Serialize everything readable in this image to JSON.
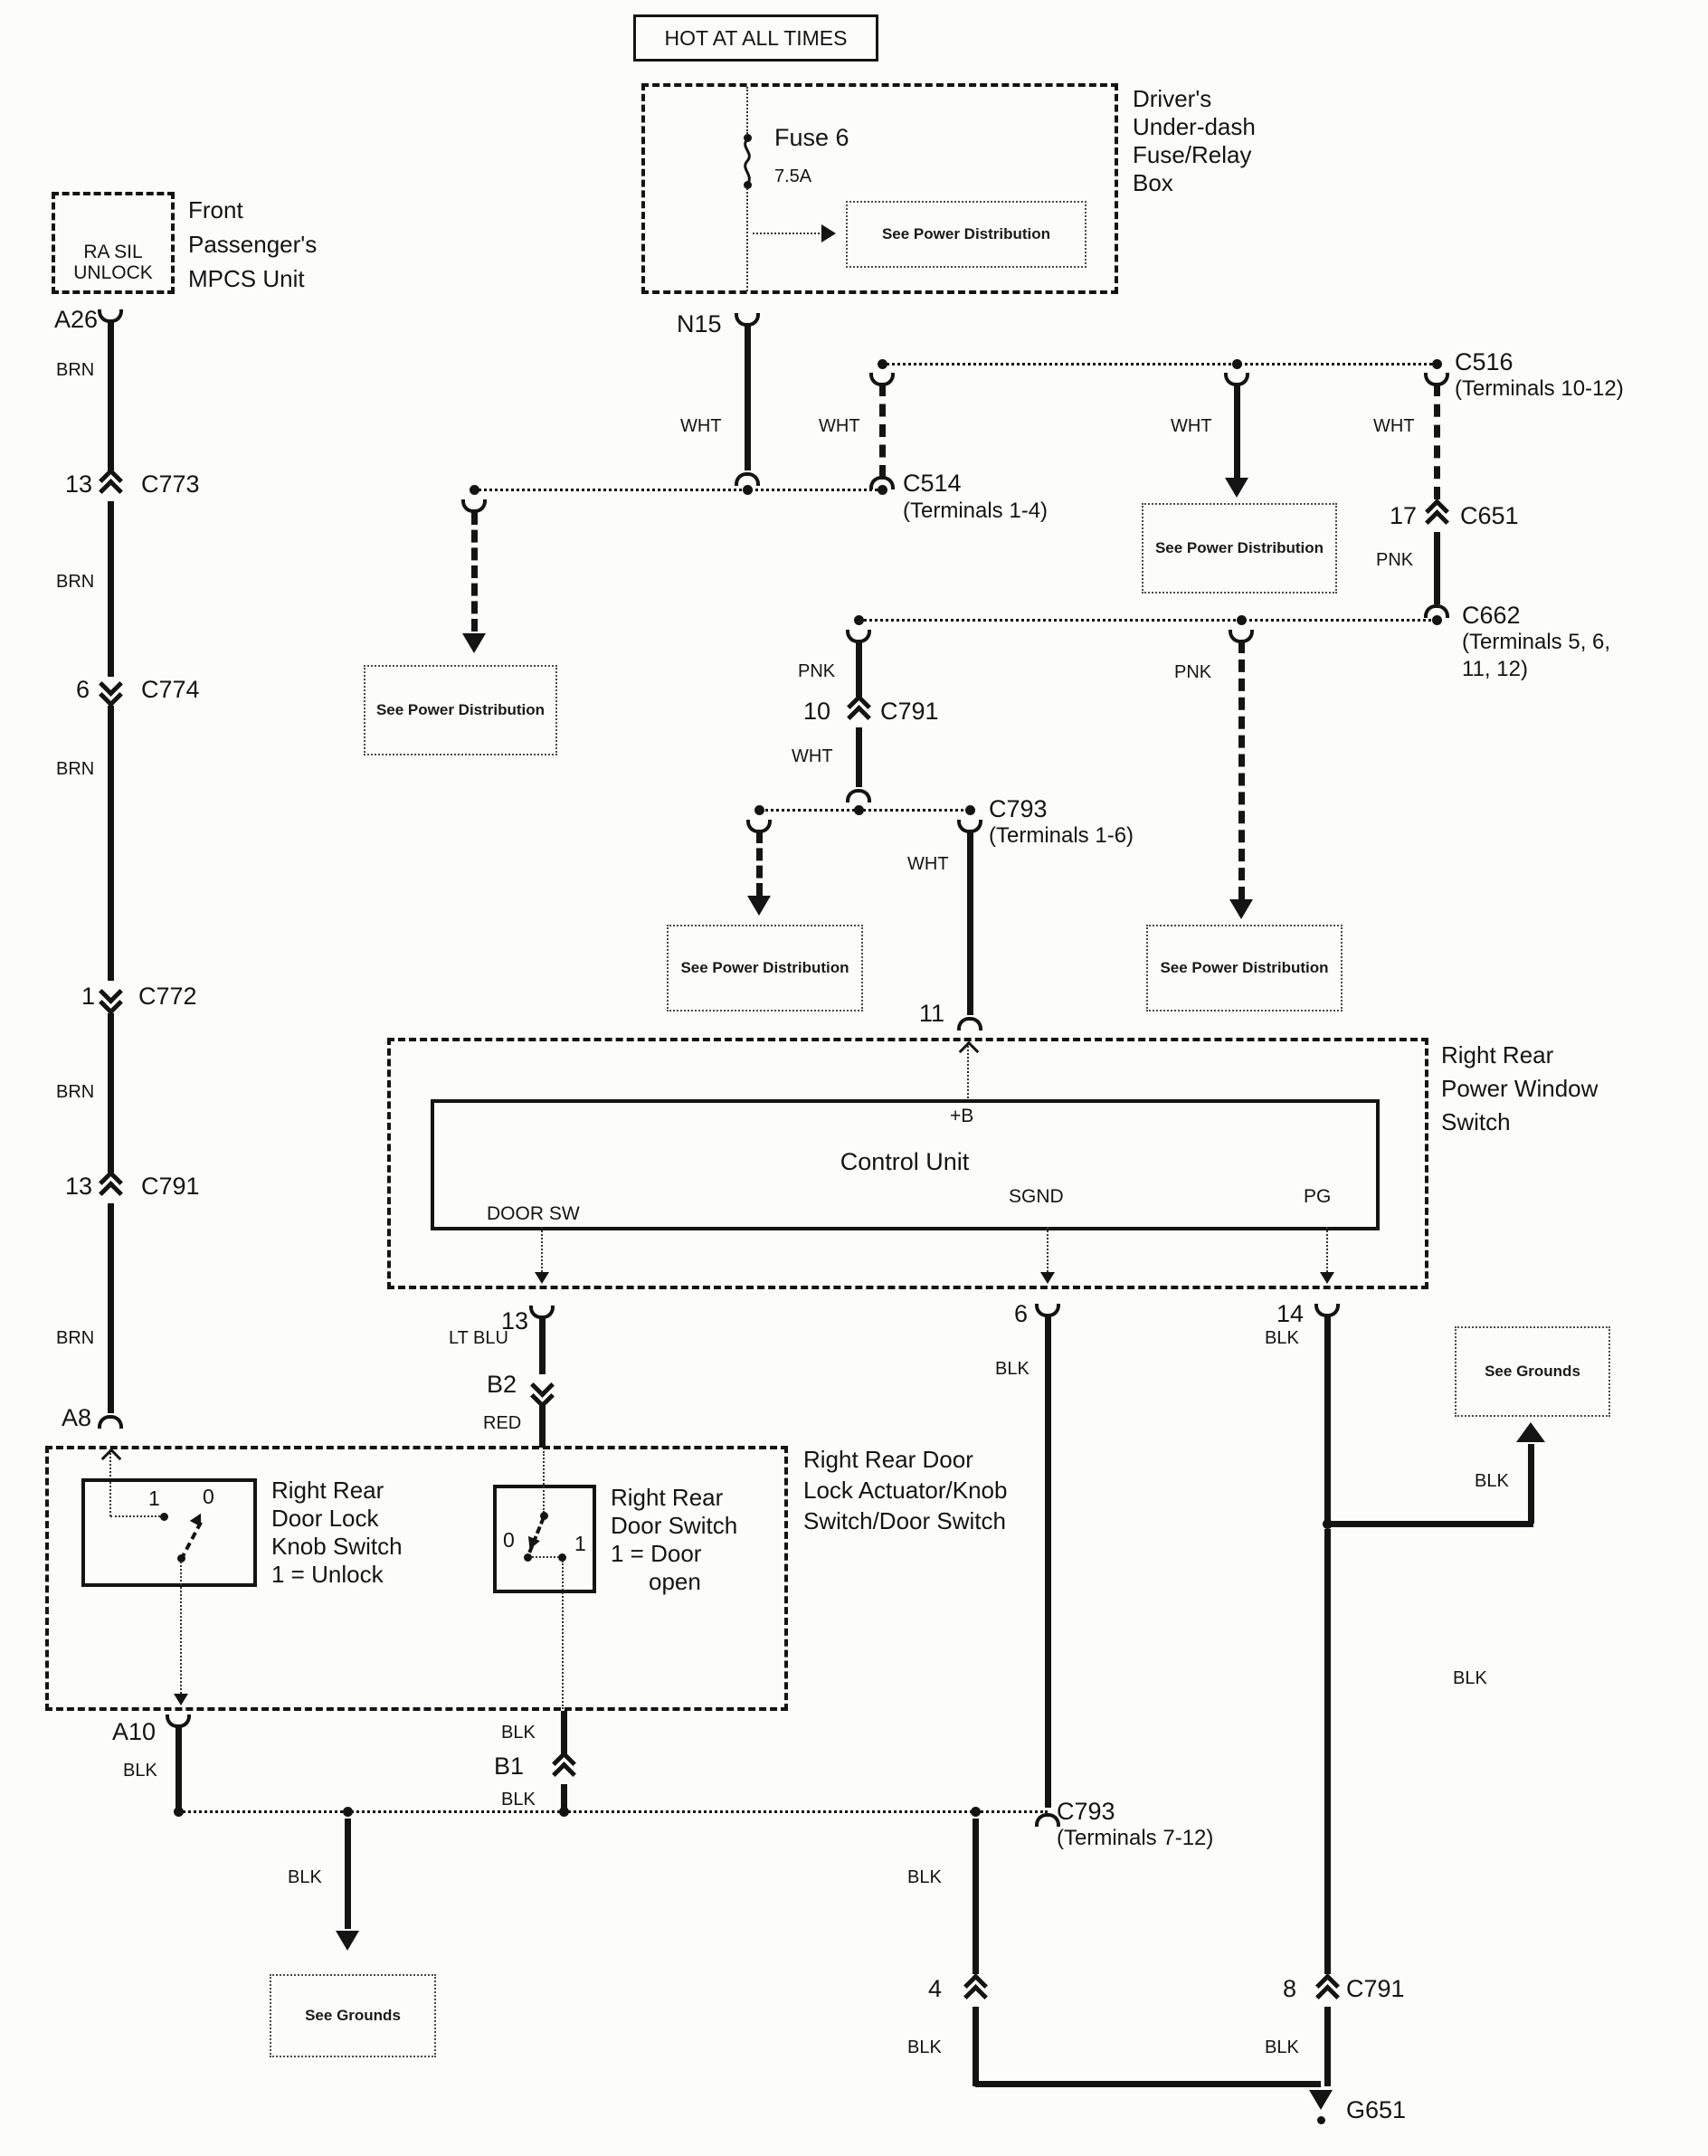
{
  "banner": "HOT AT ALL TIMES",
  "fuse_box": {
    "title": [
      "Driver's",
      "Under-dash",
      "Fuse/Relay",
      "Box"
    ],
    "fuse": "Fuse 6",
    "rating": "7.5A",
    "terminal": "N15"
  },
  "refs": {
    "see_power": "See Power Distribution",
    "see_grounds": "See Grounds"
  },
  "colors": {
    "brn": "BRN",
    "wht": "WHT",
    "pnk": "PNK",
    "blk": "BLK",
    "ltblu": "LT BLU",
    "red": "RED"
  },
  "mpcs": {
    "signal": [
      "RA SIL",
      "UNLOCK"
    ],
    "title": [
      "Front",
      "Passenger's",
      "MPCS Unit"
    ],
    "pin_top": "A26",
    "pin_bottom": "A8"
  },
  "connectors": {
    "c773": {
      "pin": "13",
      "name": "C773"
    },
    "c774": {
      "pin": "6",
      "name": "C774"
    },
    "c772": {
      "pin": "1",
      "name": "C772"
    },
    "c791_left": {
      "pin": "13",
      "name": "C791"
    },
    "c514": {
      "name": "C514",
      "terminals": "(Terminals 1-4)"
    },
    "c516": {
      "name": "C516",
      "terminals": "(Terminals 10-12)"
    },
    "c651": {
      "pin": "17",
      "name": "C651"
    },
    "c662": {
      "name": "C662",
      "terminals": [
        "(Terminals 5, 6,",
        "11, 12)"
      ]
    },
    "c791_mid": {
      "pin": "10",
      "name": "C791"
    },
    "c793_upper": {
      "name": "C793",
      "terminals": "(Terminals 1-6)"
    },
    "c793_lower": {
      "name": "C793",
      "terminals": "(Terminals 7-12)"
    },
    "c791_center": {
      "pin": "4"
    },
    "c791_right": {
      "pin": "8",
      "name": "C791"
    },
    "b2": "B2",
    "b1": "B1",
    "a10": "A10",
    "g651": "G651"
  },
  "window_switch": {
    "title": [
      "Right Rear",
      "Power Window",
      "Switch"
    ],
    "unit": "Control Unit",
    "plus_b": "+B",
    "door_sw": "DOOR SW",
    "sgnd": "SGND",
    "pg": "PG",
    "pin_in": "11",
    "pin_door": "13",
    "pin_sgnd": "6",
    "pin_pg": "14"
  },
  "actuator": {
    "title": [
      "Right Rear Door",
      "Lock Actuator/Knob",
      "Switch/Door Switch"
    ],
    "knob_switch": {
      "label": [
        "Right Rear",
        "Door Lock",
        "Knob Switch",
        "1 = Unlock"
      ],
      "pos1": "1",
      "pos0": "0"
    },
    "door_switch": {
      "label": [
        "Right Rear",
        "Door Switch",
        "1 = Door",
        "open"
      ],
      "pos0": "0",
      "pos1": "1"
    }
  }
}
